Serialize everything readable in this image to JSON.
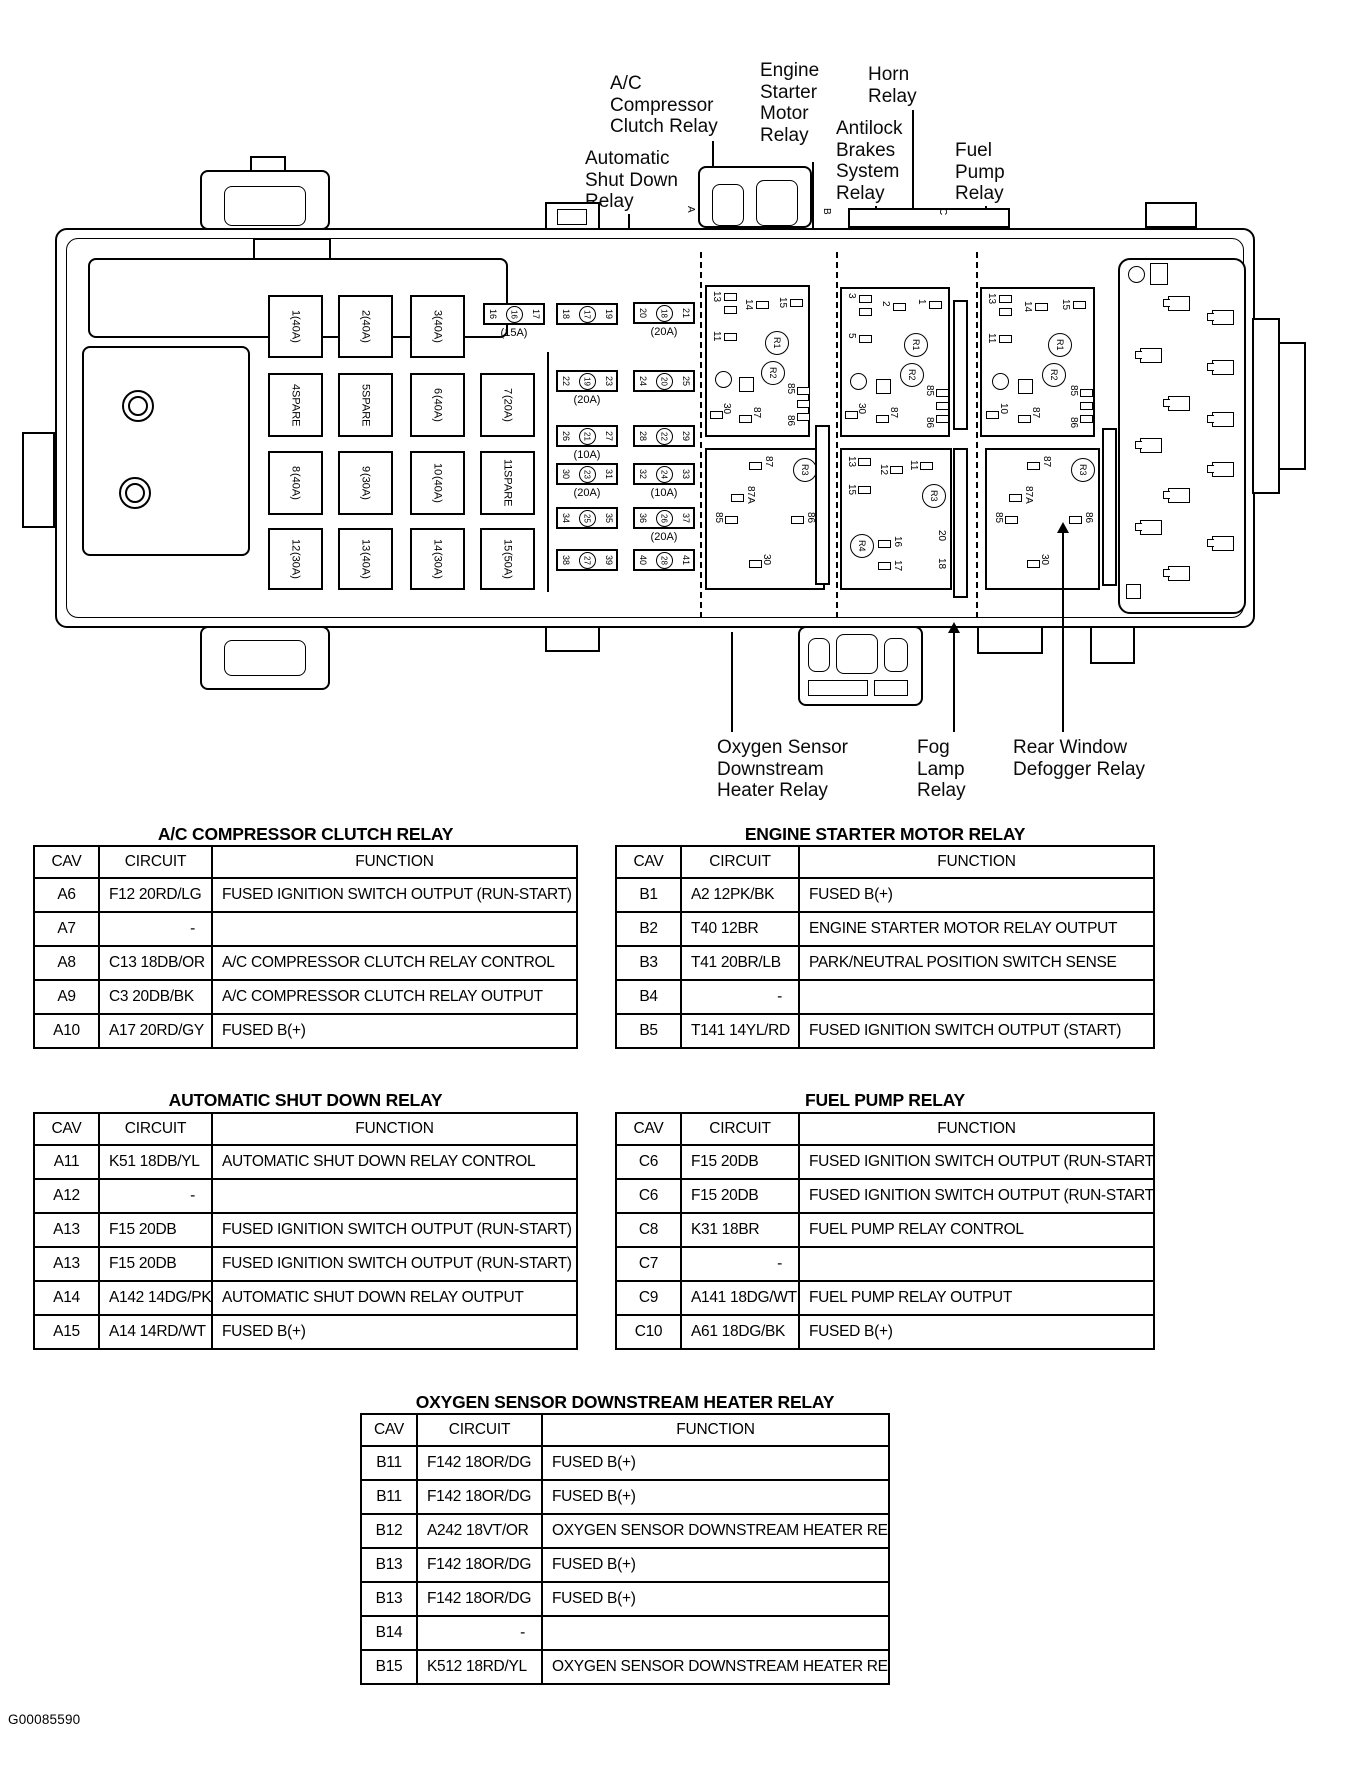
{
  "doc_id": "G00085590",
  "callouts": {
    "ac_compressor": "A/C\nCompressor\nClutch Relay",
    "engine_starter": "Engine\nStarter\nMotor\nRelay",
    "horn": "Horn\nRelay",
    "antilock": "Antilock\nBrakes\nSystem\nRelay",
    "fuel_pump": "Fuel\nPump\nRelay",
    "auto_shutdown": "Automatic\nShut Down\nRelay",
    "oxygen": "Oxygen Sensor\nDownstream\nHeater Relay",
    "fog": "Fog\nLamp\nRelay",
    "rear_defogger": "Rear Window\nDefogger Relay"
  },
  "box": {
    "section_tabs": [
      "A",
      "B",
      "C"
    ],
    "large_fuses": [
      {
        "num": "1",
        "rating": "(40A)"
      },
      {
        "num": "2",
        "rating": "(40A)"
      },
      {
        "num": "3",
        "rating": "(40A)"
      },
      {
        "num": "4",
        "rating": "SPARE"
      },
      {
        "num": "5",
        "rating": "SPARE"
      },
      {
        "num": "6",
        "rating": "(40A)"
      },
      {
        "num": "7",
        "rating": "(20A)"
      },
      {
        "num": "8",
        "rating": "(40A)"
      },
      {
        "num": "9",
        "rating": "(30A)"
      },
      {
        "num": "10",
        "rating": "(40A)"
      },
      {
        "num": "11",
        "rating": "SPARE"
      },
      {
        "num": "12",
        "rating": "(30A)"
      },
      {
        "num": "13",
        "rating": "(40A)"
      },
      {
        "num": "14",
        "rating": "(30A)"
      },
      {
        "num": "15",
        "rating": "(50A)"
      }
    ],
    "small_fuses": [
      {
        "l": "16",
        "c": "16",
        "r": "17",
        "rating": "(15A)"
      },
      {
        "l": "18",
        "c": "17",
        "r": "19",
        "rating": ""
      },
      {
        "l": "20",
        "c": "18",
        "r": "21",
        "rating": "(20A)"
      },
      {
        "l": "22",
        "c": "19",
        "r": "23",
        "rating": "(20A)"
      },
      {
        "l": "24",
        "c": "20",
        "r": "25",
        "rating": ""
      },
      {
        "l": "26",
        "c": "21",
        "r": "27",
        "rating": "(10A)"
      },
      {
        "l": "28",
        "c": "22",
        "r": "29",
        "rating": ""
      },
      {
        "l": "30",
        "c": "23",
        "r": "31",
        "rating": "(20A)"
      },
      {
        "l": "32",
        "c": "24",
        "r": "33",
        "rating": "(10A)"
      },
      {
        "l": "34",
        "c": "25",
        "r": "35",
        "rating": ""
      },
      {
        "l": "36",
        "c": "26",
        "r": "37",
        "rating": "(20A)"
      },
      {
        "l": "38",
        "c": "27",
        "r": "39",
        "rating": ""
      },
      {
        "l": "40",
        "c": "28",
        "r": "41",
        "rating": ""
      }
    ],
    "relay_a": {
      "tp0": "13",
      "tp1": "14",
      "tp2": "11",
      "tp3": "15",
      "r1": "R1",
      "r2": "R2",
      "p85": "85",
      "p86": "86",
      "p30": "30",
      "p87": "87"
    },
    "relay_a_bot": {
      "r3": "R3",
      "p87": "87",
      "p87a": "87A",
      "p85": "85",
      "p86": "86",
      "p30": "30"
    },
    "relay_b": {
      "tp0": "3",
      "tp1": "2",
      "tp2": "5",
      "tp3": "1",
      "r1": "R1",
      "r2": "R2",
      "p85": "85",
      "p86": "86",
      "p30": "30",
      "p87": "87"
    },
    "relay_b_bot": {
      "r3": "R3",
      "p13": "13",
      "p12": "12",
      "p15": "15",
      "p11": "11",
      "r4": "R4",
      "p16": "16",
      "p17": "17",
      "p20": "20",
      "p18": "18"
    },
    "relay_c": {
      "tp0": "13",
      "tp1": "14",
      "tp2": "11",
      "tp3": "15",
      "r1": "R1",
      "r2": "R2",
      "p85": "85",
      "p86": "86",
      "p10": "10",
      "p87": "87"
    },
    "relay_c_bot": {
      "r3": "R3",
      "p87": "87",
      "p87a": "87A",
      "p85": "85",
      "p86": "86",
      "p30": "30"
    }
  },
  "tables": {
    "ac": {
      "title": "A/C COMPRESSOR CLUTCH RELAY",
      "headers": [
        "CAV",
        "CIRCUIT",
        "FUNCTION"
      ],
      "rows": [
        {
          "cav": "A6",
          "circuit": "F12 20RD/LG",
          "function": "FUSED IGNITION SWITCH OUTPUT (RUN-START)"
        },
        {
          "cav": "A7",
          "circuit": "-",
          "function": ""
        },
        {
          "cav": "A8",
          "circuit": "C13 18DB/OR",
          "function": "A/C COMPRESSOR CLUTCH RELAY CONTROL"
        },
        {
          "cav": "A9",
          "circuit": "C3 20DB/BK",
          "function": "A/C COMPRESSOR CLUTCH RELAY OUTPUT"
        },
        {
          "cav": "A10",
          "circuit": "A17 20RD/GY",
          "function": "FUSED B(+)"
        }
      ]
    },
    "starter": {
      "title": "ENGINE STARTER MOTOR RELAY",
      "headers": [
        "CAV",
        "CIRCUIT",
        "FUNCTION"
      ],
      "rows": [
        {
          "cav": "B1",
          "circuit": "A2 12PK/BK",
          "function": "FUSED B(+)"
        },
        {
          "cav": "B2",
          "circuit": "T40 12BR",
          "function": "ENGINE STARTER MOTOR RELAY OUTPUT"
        },
        {
          "cav": "B3",
          "circuit": "T41 20BR/LB",
          "function": "PARK/NEUTRAL POSITION SWITCH SENSE"
        },
        {
          "cav": "B4",
          "circuit": "-",
          "function": ""
        },
        {
          "cav": "B5",
          "circuit": "T141 14YL/RD",
          "function": "FUSED IGNITION SWITCH OUTPUT (START)"
        }
      ]
    },
    "asd": {
      "title": "AUTOMATIC SHUT DOWN RELAY",
      "headers": [
        "CAV",
        "CIRCUIT",
        "FUNCTION"
      ],
      "rows": [
        {
          "cav": "A11",
          "circuit": "K51 18DB/YL",
          "function": "AUTOMATIC SHUT DOWN RELAY CONTROL"
        },
        {
          "cav": "A12",
          "circuit": "-",
          "function": ""
        },
        {
          "cav": "A13",
          "circuit": "F15 20DB",
          "function": "FUSED IGNITION SWITCH OUTPUT (RUN-START)"
        },
        {
          "cav": "A13",
          "circuit": "F15 20DB",
          "function": "FUSED IGNITION SWITCH OUTPUT (RUN-START)"
        },
        {
          "cav": "A14",
          "circuit": "A142 14DG/PK",
          "function": "AUTOMATIC SHUT DOWN RELAY OUTPUT"
        },
        {
          "cav": "A15",
          "circuit": "A14 14RD/WT",
          "function": "FUSED B(+)"
        }
      ]
    },
    "fuel": {
      "title": "FUEL PUMP RELAY",
      "headers": [
        "CAV",
        "CIRCUIT",
        "FUNCTION"
      ],
      "rows": [
        {
          "cav": "C6",
          "circuit": "F15 20DB",
          "function": "FUSED IGNITION SWITCH OUTPUT (RUN-START)"
        },
        {
          "cav": "C6",
          "circuit": "F15 20DB",
          "function": "FUSED IGNITION SWITCH OUTPUT (RUN-START)"
        },
        {
          "cav": "C8",
          "circuit": "K31 18BR",
          "function": "FUEL PUMP RELAY CONTROL"
        },
        {
          "cav": "C7",
          "circuit": "-",
          "function": ""
        },
        {
          "cav": "C9",
          "circuit": "A141 18DG/WT",
          "function": "FUEL PUMP RELAY OUTPUT"
        },
        {
          "cav": "C10",
          "circuit": "A61 18DG/BK",
          "function": "FUSED B(+)"
        }
      ]
    },
    "oxygen": {
      "title": "OXYGEN SENSOR DOWNSTREAM HEATER RELAY",
      "headers": [
        "CAV",
        "CIRCUIT",
        "FUNCTION"
      ],
      "rows": [
        {
          "cav": "B11",
          "circuit": "F142 18OR/DG",
          "function": "FUSED B(+)"
        },
        {
          "cav": "B11",
          "circuit": "F142 18OR/DG",
          "function": "FUSED B(+)"
        },
        {
          "cav": "B12",
          "circuit": "A242 18VT/OR",
          "function": "OXYGEN SENSOR DOWNSTREAM HEATER RELAY"
        },
        {
          "cav": "B13",
          "circuit": "F142 18OR/DG",
          "function": "FUSED B(+)"
        },
        {
          "cav": "B13",
          "circuit": "F142 18OR/DG",
          "function": "FUSED B(+)"
        },
        {
          "cav": "B14",
          "circuit": "-",
          "function": ""
        },
        {
          "cav": "B15",
          "circuit": "K512 18RD/YL",
          "function": "OXYGEN SENSOR DOWNSTREAM HEATER RELAY"
        }
      ]
    }
  }
}
